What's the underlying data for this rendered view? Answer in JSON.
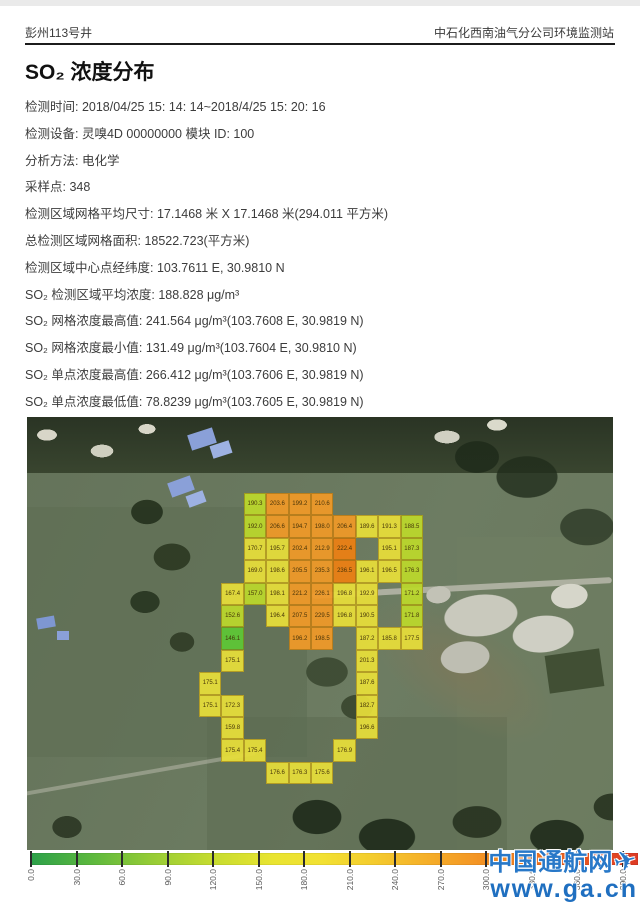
{
  "header": {
    "left": "彭州113号井",
    "right": "中石化西南油气分公司环境监测站"
  },
  "title": "SO₂ 浓度分布",
  "metadata": {
    "lines": [
      "检测时间: 2018/04/25 15: 14: 14~2018/4/25 15: 20: 16",
      "检测设备: 灵嗅4D 00000000 模块 ID: 100",
      "分析方法: 电化学",
      "采样点:  348",
      "检测区域网格平均尺寸:  17.1468 米 X 17.1468 米(294.011 平方米)",
      "总检测区域网格面积:  18522.723(平方米)",
      "检测区域中心点经纬度:  103.7611 E, 30.9810 N",
      "SO₂ 检测区域平均浓度: 188.828 μg/m³",
      "SO₂ 网格浓度最高值:  241.564 μg/m³(103.7608 E, 30.9819 N)",
      "SO₂ 网格浓度最小值: 131.49 μg/m³(103.7604 E, 30.9810 N)",
      "SO₂ 单点浓度最高值:  266.412 μg/m³(103.7606 E, 30.9819 N)",
      "SO₂ 单点浓度最低值:  78.8239 μg/m³(103.7605 E, 30.9819 N)"
    ]
  },
  "chart_data": {
    "type": "heatmap",
    "title": "SO₂ 浓度分布",
    "units": "μg/m³",
    "description": "SO₂ concentration grid overlaid on satellite image; cell = [col,row,value,colorKey]",
    "grid": {
      "cols": 10,
      "rows": 13,
      "cell_px": 22.4,
      "origin_px": {
        "x": 172,
        "y": 76
      }
    },
    "palette": {
      "g": "#5ec736",
      "l": "#bcd92c",
      "y": "#e8df3a",
      "o": "#f19a28",
      "d": "#ee8013"
    },
    "cells": [
      [
        2,
        0,
        "190.3",
        "l"
      ],
      [
        3,
        0,
        "203.6",
        "o"
      ],
      [
        4,
        0,
        "199.2",
        "o"
      ],
      [
        5,
        0,
        "210.6",
        "o"
      ],
      [
        2,
        1,
        "192.0",
        "l"
      ],
      [
        3,
        1,
        "206.6",
        "o"
      ],
      [
        4,
        1,
        "194.7",
        "o"
      ],
      [
        5,
        1,
        "198.0",
        "o"
      ],
      [
        6,
        1,
        "206.4",
        "o"
      ],
      [
        7,
        1,
        "189.6",
        "y"
      ],
      [
        8,
        1,
        "191.3",
        "y"
      ],
      [
        9,
        1,
        "188.5",
        "l"
      ],
      [
        2,
        2,
        "170.7",
        "y"
      ],
      [
        3,
        2,
        "195.7",
        "y"
      ],
      [
        4,
        2,
        "202.4",
        "o"
      ],
      [
        5,
        2,
        "212.9",
        "o"
      ],
      [
        6,
        2,
        "222.4",
        "d"
      ],
      [
        8,
        2,
        "195.1",
        "y"
      ],
      [
        9,
        2,
        "187.3",
        "l"
      ],
      [
        2,
        3,
        "169.0",
        "y"
      ],
      [
        3,
        3,
        "198.6",
        "y"
      ],
      [
        4,
        3,
        "205.5",
        "o"
      ],
      [
        5,
        3,
        "235.3",
        "o"
      ],
      [
        6,
        3,
        "236.5",
        "d"
      ],
      [
        7,
        3,
        "196.1",
        "y"
      ],
      [
        8,
        3,
        "196.5",
        "y"
      ],
      [
        9,
        3,
        "176.3",
        "l"
      ],
      [
        1,
        4,
        "167.4",
        "y"
      ],
      [
        2,
        4,
        "157.0",
        "l"
      ],
      [
        3,
        4,
        "198.1",
        "y"
      ],
      [
        4,
        4,
        "221.2",
        "o"
      ],
      [
        5,
        4,
        "226.1",
        "o"
      ],
      [
        6,
        4,
        "196.8",
        "y"
      ],
      [
        7,
        4,
        "192.9",
        "y"
      ],
      [
        9,
        4,
        "171.2",
        "l"
      ],
      [
        1,
        5,
        "152.6",
        "l"
      ],
      [
        3,
        5,
        "196.4",
        "y"
      ],
      [
        4,
        5,
        "207.5",
        "o"
      ],
      [
        5,
        5,
        "229.5",
        "o"
      ],
      [
        6,
        5,
        "196.8",
        "y"
      ],
      [
        7,
        5,
        "190.5",
        "y"
      ],
      [
        9,
        5,
        "171.8",
        "l"
      ],
      [
        1,
        6,
        "146.1",
        "g"
      ],
      [
        4,
        6,
        "196.2",
        "o"
      ],
      [
        5,
        6,
        "198.5",
        "o"
      ],
      [
        7,
        6,
        "187.2",
        "y"
      ],
      [
        8,
        6,
        "185.8",
        "y"
      ],
      [
        9,
        6,
        "177.5",
        "y"
      ],
      [
        1,
        7,
        "175.1",
        "y"
      ],
      [
        7,
        7,
        "201.3",
        "y"
      ],
      [
        0,
        8,
        "175.1",
        "y"
      ],
      [
        7,
        8,
        "187.6",
        "y"
      ],
      [
        0,
        9,
        "175.1",
        "y"
      ],
      [
        1,
        9,
        "172.3",
        "y"
      ],
      [
        7,
        9,
        "182.7",
        "y"
      ],
      [
        1,
        10,
        "159.8",
        "y"
      ],
      [
        7,
        10,
        "196.6",
        "y"
      ],
      [
        1,
        11,
        "175.4",
        "y"
      ],
      [
        2,
        11,
        "175.4",
        "y"
      ],
      [
        6,
        11,
        "176.9",
        "y"
      ],
      [
        3,
        12,
        "176.6",
        "y"
      ],
      [
        4,
        12,
        "176.3",
        "y"
      ],
      [
        5,
        12,
        "175.6",
        "y"
      ]
    ],
    "stats": {
      "average": "188.828 μg/m³",
      "grid_max": "241.564 μg/m³ (103.7608 E, 30.9819 N)",
      "grid_min": "131.49 μg/m³ (103.7604 E, 30.9810 N)",
      "point_max": "266.412 μg/m³ (103.7606 E, 30.9819 N)",
      "point_min": "78.8239 μg/m³ (103.7605 E, 30.9819 N)"
    },
    "colorbar": {
      "min": 0,
      "max": 390,
      "step": 30,
      "tick_labels": [
        "0.0",
        "30.0",
        "60.0",
        "90.0",
        "120.0",
        "150.0",
        "180.0",
        "210.0",
        "240.0",
        "270.0",
        "300.0",
        "330.0",
        "360.0",
        "390.0"
      ],
      "gradient": [
        "#2ca04a",
        "#96cc36",
        "#e9e431",
        "#f4cd2e",
        "#f49a26",
        "#f07f1f",
        "#dd3a25"
      ],
      "position": "bottom"
    }
  },
  "watermark": {
    "line1": "中国通航网",
    "line2": "www.ga.cn",
    "plane_icon": "✈",
    "color": "#2878c8"
  }
}
